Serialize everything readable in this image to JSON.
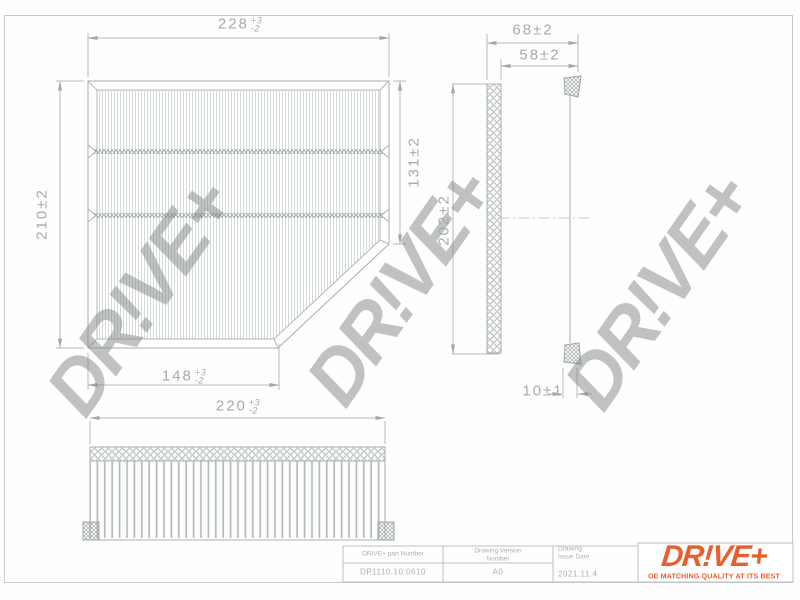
{
  "drawing": {
    "watermark_text": "DR!VE+",
    "dimensions": {
      "plan_width_top": {
        "value": "228",
        "plus": "+3",
        "minus": "-2"
      },
      "plan_height_left": "210±2",
      "plan_height_right": "131±2",
      "plan_width_bottom": {
        "value": "148",
        "plus": "+3",
        "minus": "-2"
      },
      "side_depth_outer": "68±2",
      "side_depth_inner": "58±2",
      "side_height": "202±2",
      "side_seal_width": "10±1",
      "front_width": {
        "value": "220",
        "plus": "+3",
        "minus": "-2"
      }
    }
  },
  "title_block": {
    "part_number_label": "DRIVE+  part  Number",
    "part_number_value": "DP1110.10.0610",
    "version_label": "Drawing  Version\nNumber",
    "version_value": "A0",
    "issue_date_label": "Drawing\nIssue  Date",
    "issue_date_value": "2021.11.4"
  },
  "logo": {
    "text": "DR!VE+",
    "tagline": "OE MATCHING QUALITY AT ITS BEST",
    "color": "#e85e2c"
  },
  "colors": {
    "drawing_line": "#a9b1b1",
    "dimension_text": "#a2abab",
    "watermark": "rgba(125,129,129,0.48)",
    "logo_orange": "#e85e2c"
  }
}
